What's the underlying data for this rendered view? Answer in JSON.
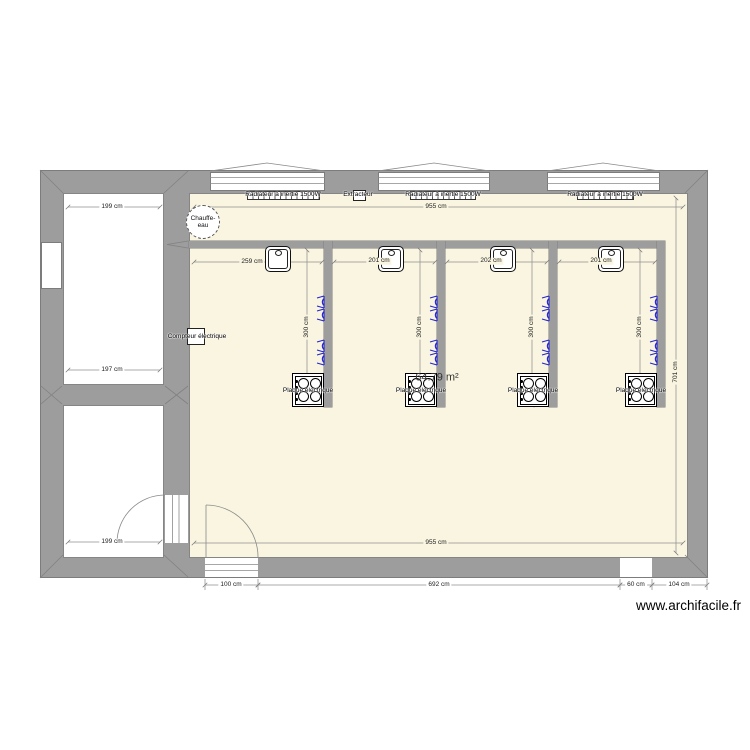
{
  "plan": {
    "area": "64.79 m²",
    "watermark": "www.archifacile.fr"
  },
  "fixtures": {
    "radiators": [
      "Radiateur à inertie 1500W",
      "Radiateur à inertie 1500W",
      "Radiateur à inertie 1500W"
    ],
    "extractor": "Extracteur",
    "water_heater": [
      "Chauffe-",
      "eau"
    ],
    "electric_meter": "Compteur électrique",
    "cooktops": [
      "Plaque électrique",
      "Plaque électrique",
      "Plaque électrique",
      "Plaque électrique"
    ]
  },
  "dims": {
    "top": "955 cm",
    "bottom_inner": "955 cm",
    "left_room_top": "199 cm",
    "left_room_mid": "197 cm",
    "left_room_bottom": "199 cm",
    "bays": [
      "259 cm",
      "201 cm",
      "202 cm",
      "201 cm"
    ],
    "partitions": [
      "300 cm",
      "300 cm",
      "300 cm",
      "300 cm"
    ],
    "right": "701 cm",
    "bottom": [
      "100 cm",
      "692 cm",
      "60 cm",
      "104 cm"
    ]
  },
  "colors": {
    "wall": "#9d9d9d",
    "floor": "#f9f5e1",
    "outlet": "#2424cc"
  }
}
